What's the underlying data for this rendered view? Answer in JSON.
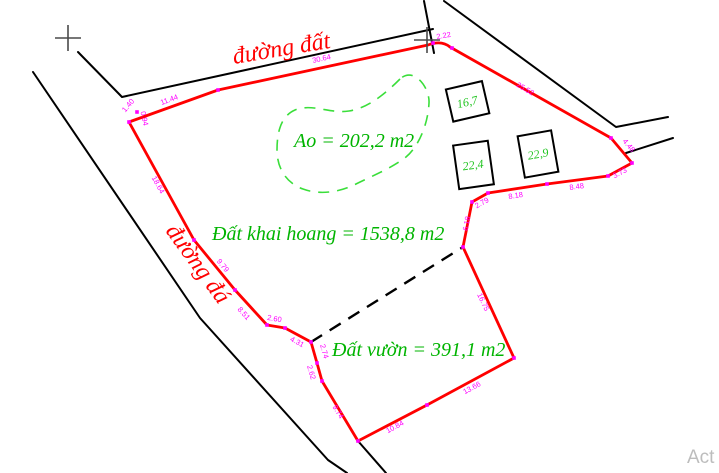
{
  "drawing": {
    "roads": {
      "top_label": "đường đất",
      "left_label": "đường đá"
    },
    "areas": {
      "pond_label": "Ao = 202,2 m2",
      "reclaimed_label": "Đất khai hoang = 1538,8 m2",
      "garden_label": "Đất vườn = 391,1 m2"
    },
    "buildings": [
      "16,7",
      "22,4",
      "22,9"
    ],
    "dimensions": [
      {
        "label": "1.40",
        "x": 130,
        "y": 107,
        "angle": -50
      },
      {
        "label": "0.94",
        "x": 142,
        "y": 119,
        "angle": 78
      },
      {
        "label": "11.44",
        "x": 170,
        "y": 102,
        "angle": -20
      },
      {
        "label": "30.64",
        "x": 322,
        "y": 61,
        "angle": -12
      },
      {
        "label": "2.22",
        "x": 444,
        "y": 38,
        "angle": -10
      },
      {
        "label": "25.52",
        "x": 524,
        "y": 91,
        "angle": 30
      },
      {
        "label": "4.48",
        "x": 627,
        "y": 147,
        "angle": 50
      },
      {
        "label": "3.73",
        "x": 621,
        "y": 175,
        "angle": -28
      },
      {
        "label": "8.48",
        "x": 577,
        "y": 189,
        "angle": -8
      },
      {
        "label": "8.18",
        "x": 516,
        "y": 198,
        "angle": -9
      },
      {
        "label": "2.79",
        "x": 483,
        "y": 205,
        "angle": -29
      },
      {
        "label": "6.18",
        "x": 469,
        "y": 224,
        "angle": -79
      },
      {
        "label": "16.75",
        "x": 481,
        "y": 303,
        "angle": 65
      },
      {
        "label": "13.66",
        "x": 473,
        "y": 390,
        "angle": -28
      },
      {
        "label": "10.84",
        "x": 396,
        "y": 429,
        "angle": -28
      },
      {
        "label": "9.74",
        "x": 336,
        "y": 413,
        "angle": 59
      },
      {
        "label": "2.62",
        "x": 309,
        "y": 373,
        "angle": 74
      },
      {
        "label": "2.74",
        "x": 322,
        "y": 352,
        "angle": 74
      },
      {
        "label": "4.31",
        "x": 296,
        "y": 344,
        "angle": 28
      },
      {
        "label": "2.60",
        "x": 274,
        "y": 321,
        "angle": 10
      },
      {
        "label": "8.51",
        "x": 242,
        "y": 315,
        "angle": 48
      },
      {
        "label": "9.79",
        "x": 221,
        "y": 267,
        "angle": 51
      },
      {
        "label": "18.64",
        "x": 156,
        "y": 186,
        "angle": 61
      }
    ],
    "watermark": "Act",
    "colors": {
      "boundary": "#ff0000",
      "dimension_text": "#ff00ff",
      "area_text": "#00b400",
      "pond_outline": "#3ade3a",
      "road_lines": "#000000",
      "road_text": "#ff0000",
      "watermark": "#bdbdbd"
    }
  }
}
